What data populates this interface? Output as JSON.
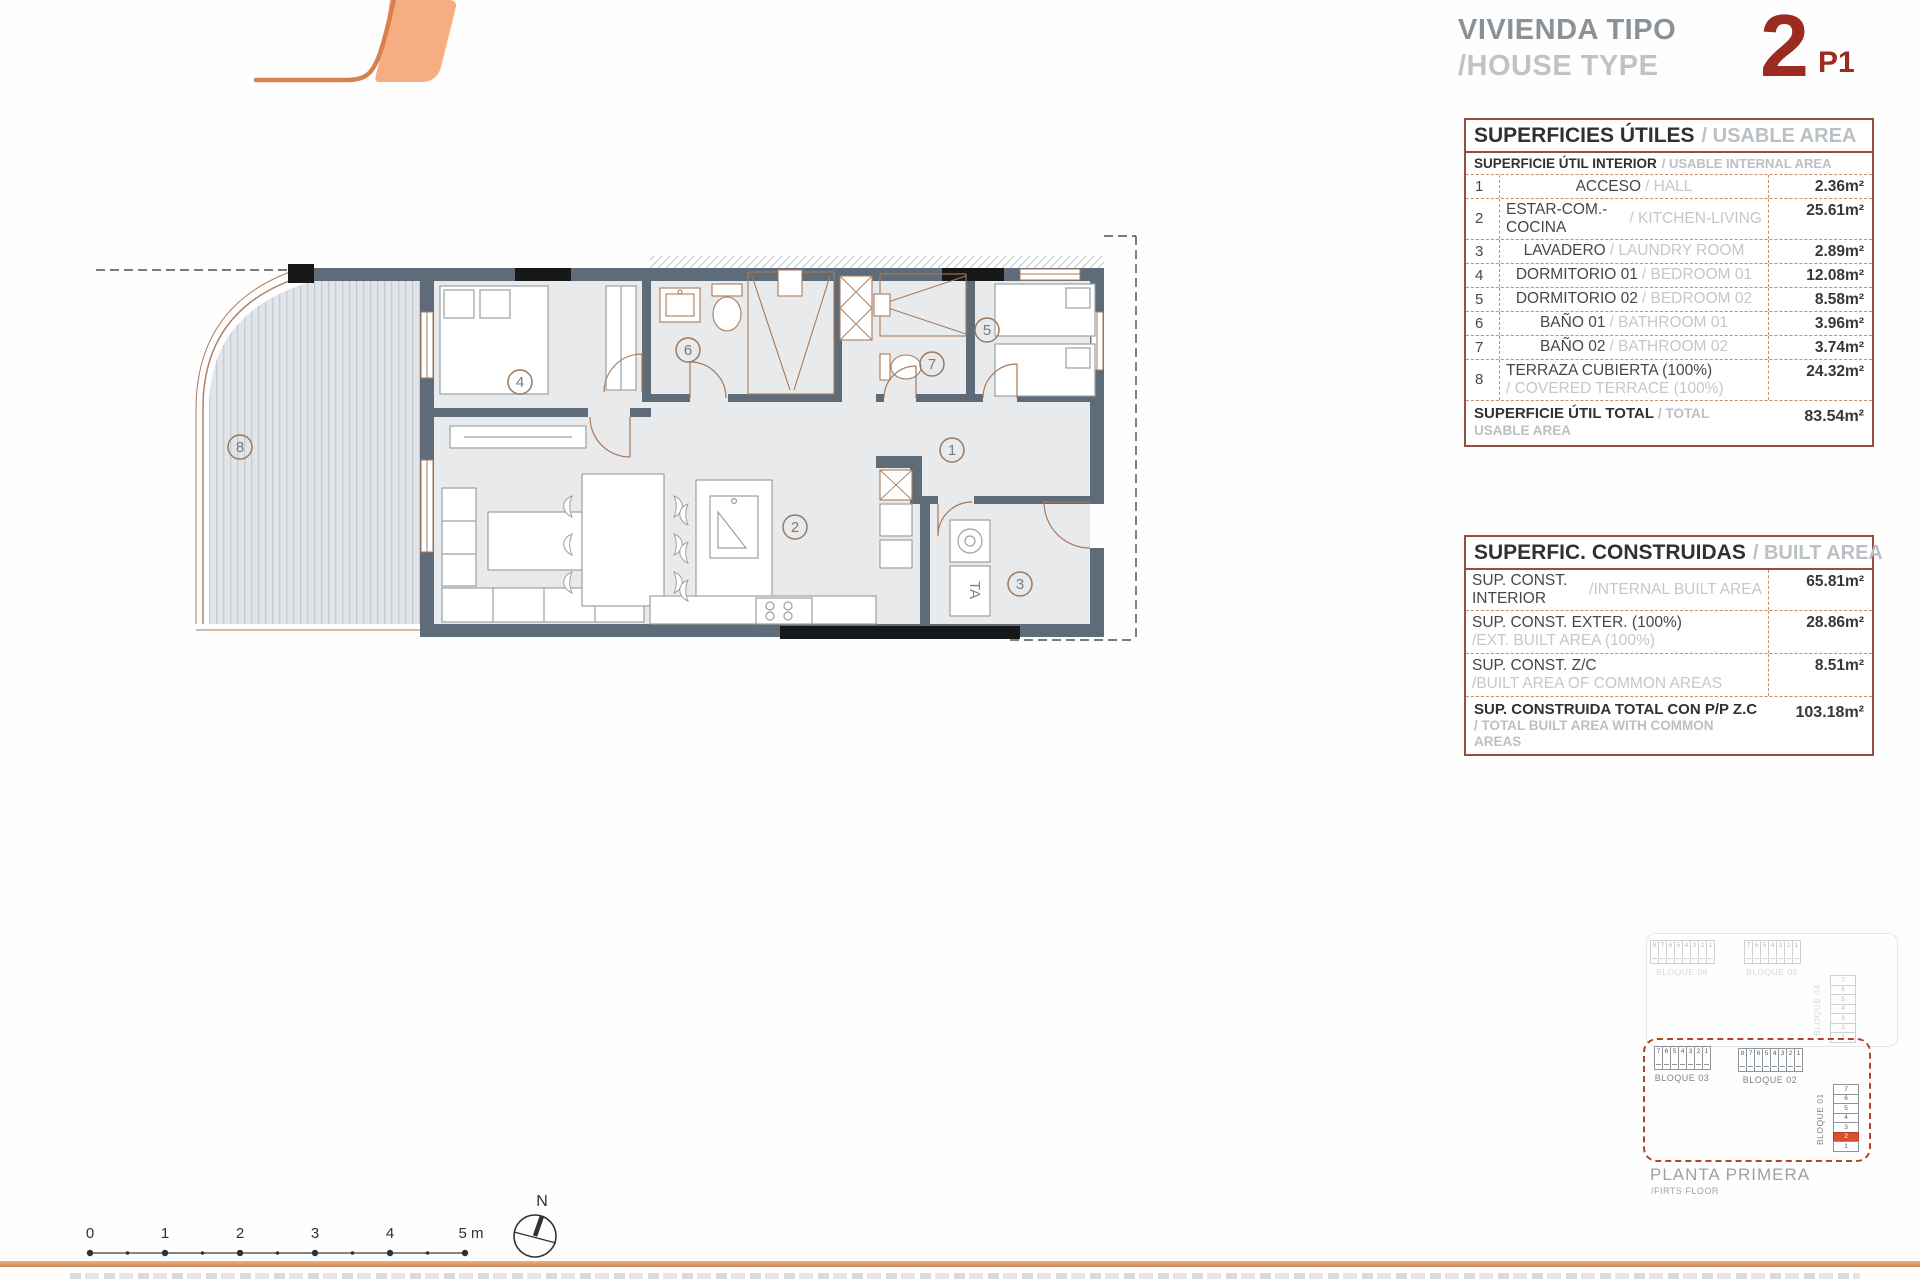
{
  "header": {
    "title_line1": "VIVIENDA TIPO",
    "title_line2": "/HOUSE TYPE",
    "type_number": "2",
    "type_suffix": "P1"
  },
  "usable_area": {
    "title_es": "SUPERFICIES ÚTILES",
    "title_en": "/ USABLE AREA",
    "subtitle_es": "SUPERFICIE ÚTIL INTERIOR",
    "subtitle_en": "/ USABLE INTERNAL AREA",
    "rows": [
      {
        "num": "1",
        "es": "ACCESO",
        "en": "/ HALL",
        "value": "2.36m²",
        "two_line": false
      },
      {
        "num": "2",
        "es": "ESTAR-COM.-COCINA",
        "en": "/ KITCHEN-LIVING",
        "value": "25.61m²",
        "two_line": false
      },
      {
        "num": "3",
        "es": "LAVADERO",
        "en": "/ LAUNDRY ROOM",
        "value": "2.89m²",
        "two_line": false
      },
      {
        "num": "4",
        "es": "DORMITORIO 01",
        "en": "/ BEDROOM 01",
        "value": "12.08m²",
        "two_line": false
      },
      {
        "num": "5",
        "es": "DORMITORIO 02",
        "en": "/ BEDROOM 02",
        "value": "8.58m²",
        "two_line": false
      },
      {
        "num": "6",
        "es": "BAÑO 01",
        "en": "/ BATHROOM 01",
        "value": "3.96m²",
        "two_line": false
      },
      {
        "num": "7",
        "es": "BAÑO 02",
        "en": "/ BATHROOM 02",
        "value": "3.74m²",
        "two_line": false
      },
      {
        "num": "8",
        "es": "TERRAZA CUBIERTA (100%)",
        "en": "/ COVERED TERRACE (100%)",
        "value": "24.32m²",
        "two_line": true
      }
    ],
    "total": {
      "es": "SUPERFICIE ÚTIL TOTAL",
      "en": "/ TOTAL USABLE AREA",
      "value": "83.54m²"
    }
  },
  "built_area": {
    "title_es": "SUPERFIC. CONSTRUIDAS",
    "title_en": "/ BUILT AREA",
    "rows": [
      {
        "es": "SUP. CONST. INTERIOR",
        "en": "/INTERNAL BUILT AREA",
        "value": "65.81m²",
        "two_line": false
      },
      {
        "es": "SUP. CONST. EXTER. (100%)",
        "en": "/EXT. BUILT AREA (100%)",
        "value": "28.86m²",
        "two_line": true
      },
      {
        "es": "SUP. CONST. Z/C",
        "en": "/BUILT AREA OF COMMON AREAS",
        "value": "8.51m²",
        "two_line": true
      }
    ],
    "total": {
      "es": "SUP. CONSTRUIDA TOTAL CON P/P Z.C",
      "en": "/ TOTAL BUILT AREA WITH COMMON AREAS",
      "value": "103.18m²"
    }
  },
  "plan": {
    "room_numbers": [
      "1",
      "2",
      "3",
      "4",
      "5",
      "6",
      "7",
      "8"
    ],
    "ta_label": "TA"
  },
  "site_map": {
    "blocks_upper": [
      {
        "label": "BLOQUE 06",
        "cells": [
          "8",
          "7",
          "6",
          "5",
          "4",
          "3",
          "2",
          "1"
        ]
      },
      {
        "label": "BLOQUE 05",
        "cells": [
          "7",
          "6",
          "5",
          "4",
          "3",
          "2",
          "1"
        ]
      },
      {
        "label": "BLOQUE 04",
        "cells": [
          "7",
          "6",
          "5",
          "4",
          "3",
          "2",
          "1"
        ]
      }
    ],
    "blocks_active": [
      {
        "label": "BLOQUE 03",
        "cells": [
          "7",
          "6",
          "5",
          "4",
          "3",
          "2",
          "1"
        ]
      },
      {
        "label": "BLOQUE 02",
        "cells": [
          "8",
          "7",
          "6",
          "5",
          "4",
          "3",
          "2",
          "1"
        ]
      },
      {
        "label": "BLOQUE 01",
        "cells": [
          "7",
          "6",
          "5",
          "4",
          "3",
          "2",
          "1"
        ],
        "highlight": "2"
      }
    ],
    "floor_label_es": "PLANTA PRIMERA",
    "floor_label_en": "/FIRTS FLOOR"
  },
  "scale_bar": {
    "labels": [
      "0",
      "1",
      "2",
      "3",
      "4",
      "5 m"
    ]
  },
  "compass": {
    "label": "N"
  },
  "colors": {
    "logo_fill": "#f5ad82",
    "logo_stroke": "#d9814e",
    "title_red": "#9b2b20",
    "table_border": "#93503a",
    "table_dash": "#c98d6b",
    "wall": "#5d6c78",
    "terrace": "#e1e5e9",
    "site_highlight": "#d4502e",
    "footer_rule": "#dd9b66"
  }
}
